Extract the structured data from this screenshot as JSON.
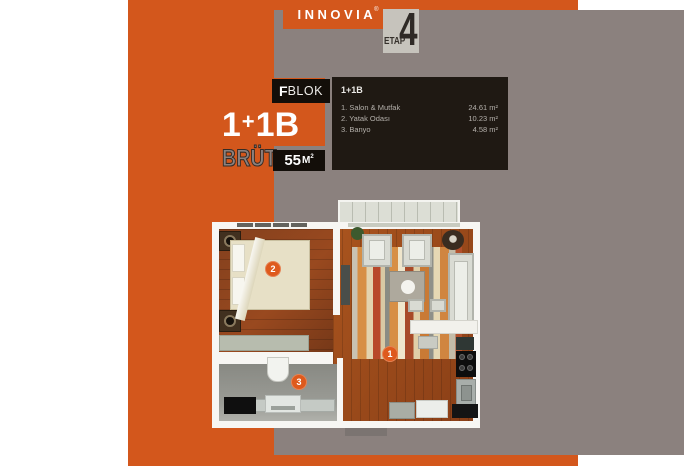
{
  "brand": {
    "name": "INNOVIA",
    "registered_mark": "®",
    "etap_label": "ETAP",
    "etap_number": "4"
  },
  "info": {
    "type_parts": [
      "1",
      "+",
      "1B"
    ],
    "block_letter": "F",
    "block_word": "BLOK",
    "brut_label": "BRÜT",
    "brut_value": "55",
    "brut_unit": "M",
    "brut_sup": "2"
  },
  "panel": {
    "header": "1+1B",
    "rooms": [
      {
        "label": "1. Salon & Mutfak",
        "area": "24.61 m²"
      },
      {
        "label": "2. Yatak Odası",
        "area": "10.23 m²"
      },
      {
        "label": "3. Banyo",
        "area": "4.58 m²"
      }
    ]
  },
  "plan": {
    "badges": [
      {
        "number": "1",
        "room": "salon-mutfak"
      },
      {
        "number": "2",
        "room": "yatak-odasi"
      },
      {
        "number": "3",
        "room": "banyo"
      }
    ]
  },
  "colors": {
    "accent_orange": "#d3571c",
    "background_gray": "#8b817e",
    "panel_black": "#1f1913"
  }
}
